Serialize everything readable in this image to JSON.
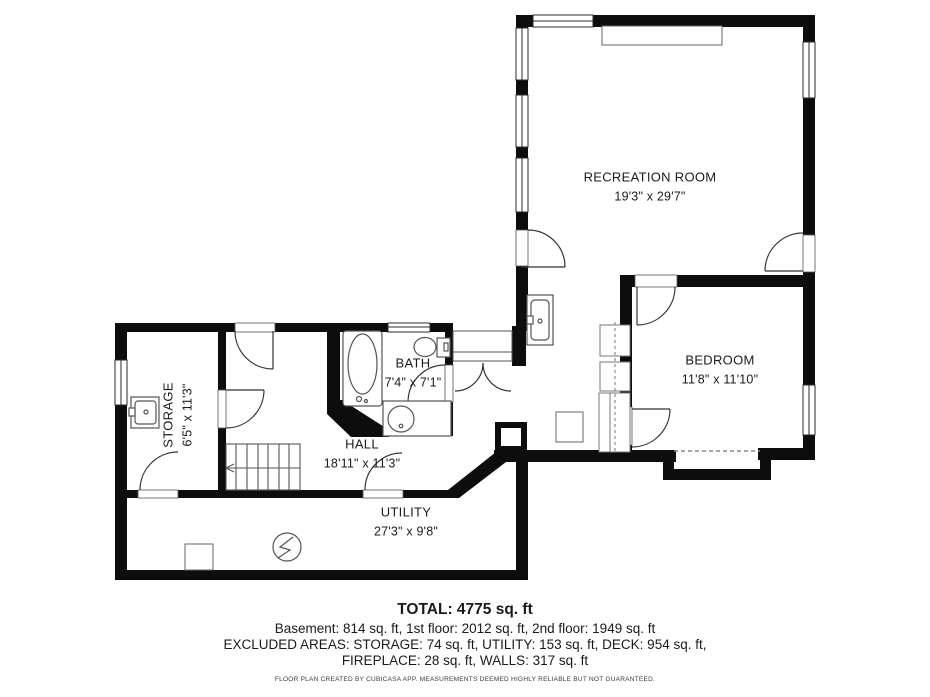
{
  "plan": {
    "rooms": [
      {
        "name": "RECREATION ROOM",
        "dims": "19'3\" x 29'7\""
      },
      {
        "name": "BEDROOM",
        "dims": "11'8\" x 11'10\""
      },
      {
        "name": "BATH",
        "dims": "7'4\" x 7'1\""
      },
      {
        "name": "HALL",
        "dims": "18'11\" x 11'3\""
      },
      {
        "name": "STORAGE",
        "dims": "6'5\" x 11'3\""
      },
      {
        "name": "UTILITY",
        "dims": "27'3\" x 9'8\""
      }
    ],
    "colors": {
      "wall": "#0d0d0d",
      "fixture": "#555555",
      "background": "#ffffff"
    }
  },
  "summary": {
    "total": "TOTAL: 4775 sq. ft",
    "floors": "Basement: 814 sq. ft, 1st floor: 2012 sq. ft, 2nd floor: 1949 sq. ft",
    "excluded1": "EXCLUDED AREAS: STORAGE: 74 sq. ft, UTILITY: 153 sq. ft, DECK: 954 sq. ft,",
    "excluded2": "FIREPLACE: 28 sq. ft, WALLS: 317 sq. ft",
    "disclaimer": "FLOOR PLAN CREATED BY CUBICASA APP. MEASUREMENTS DEEMED HIGHLY RELIABLE BUT NOT GUARANTEED."
  }
}
